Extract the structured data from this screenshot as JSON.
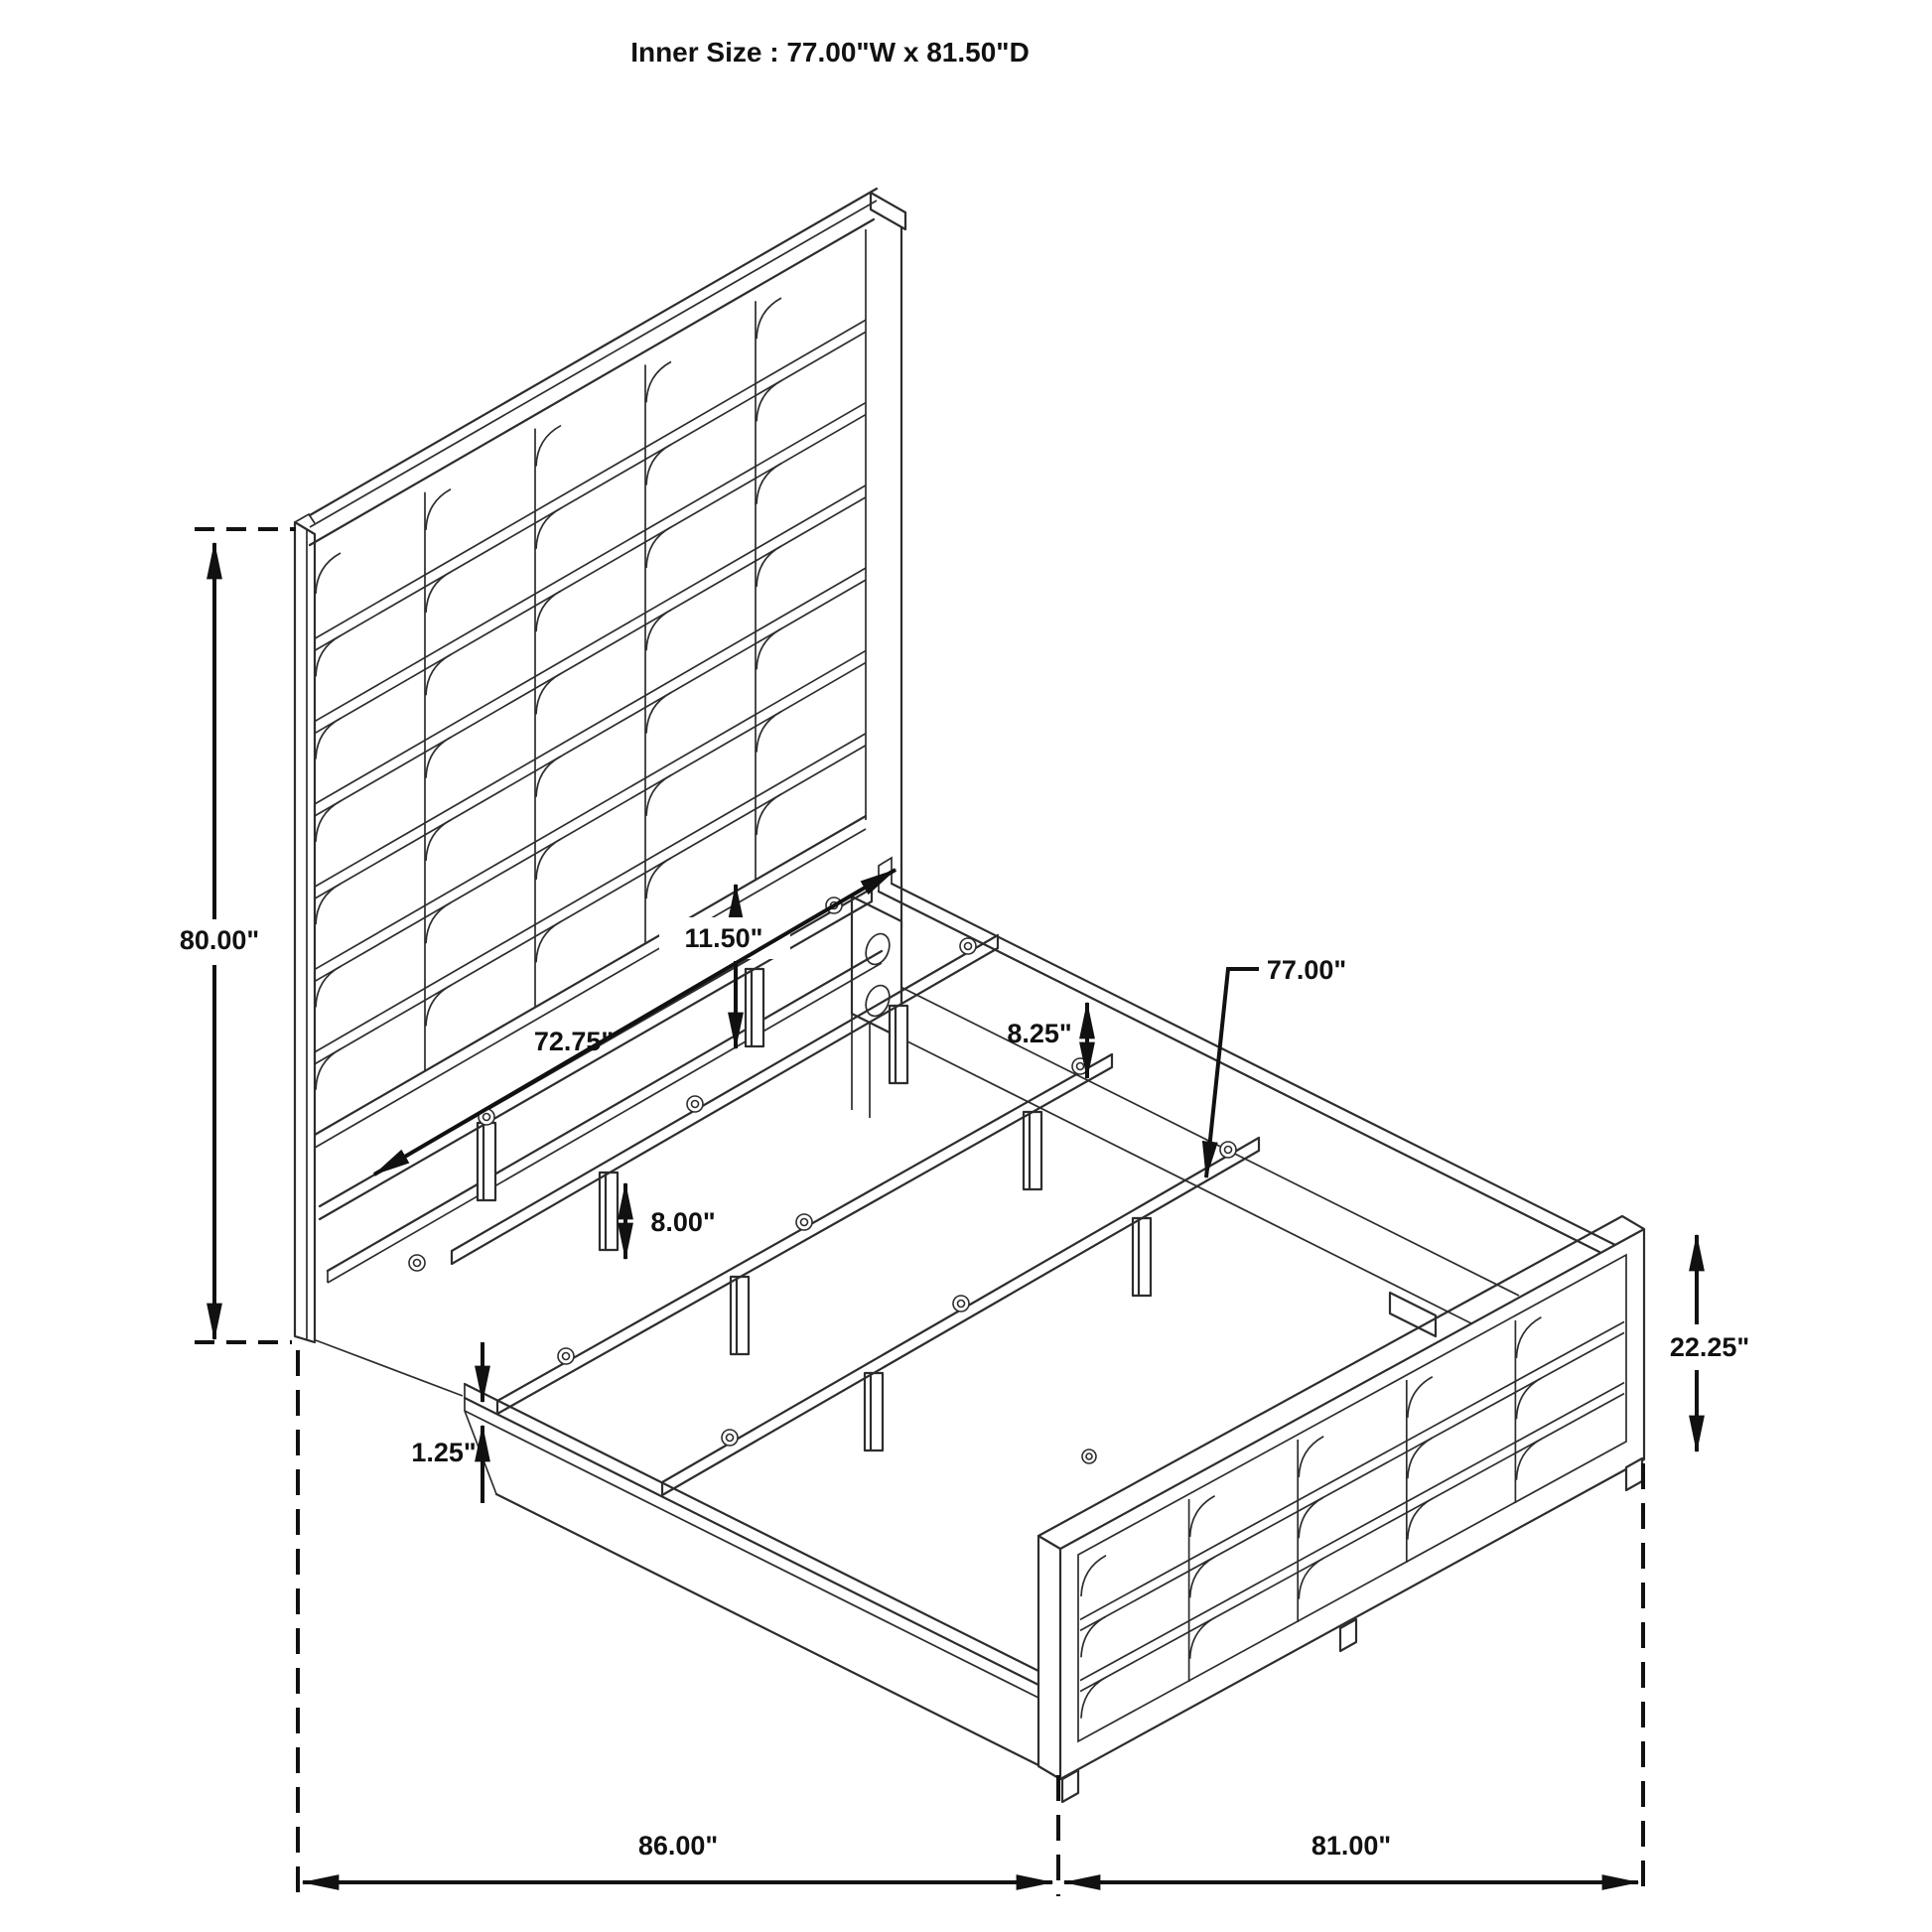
{
  "title": "Inner Size : 77.00\"W x 81.50\"D",
  "labels": {
    "headboard_height": "80.00\"",
    "headboard_clearance": "11.50\"",
    "support_rail_length": "72.75\"",
    "rail_to_slat": "8.25\"",
    "slat_length": "77.00\"",
    "slat_leg_height": "8.00\"",
    "rail_lip": "1.25\"",
    "footboard_height": "22.25\"",
    "overall_length": "86.00\"",
    "overall_width": "81.00\""
  },
  "colors": {
    "line": "#2d2d2d",
    "dimension": "#111111",
    "background": "#ffffff"
  }
}
